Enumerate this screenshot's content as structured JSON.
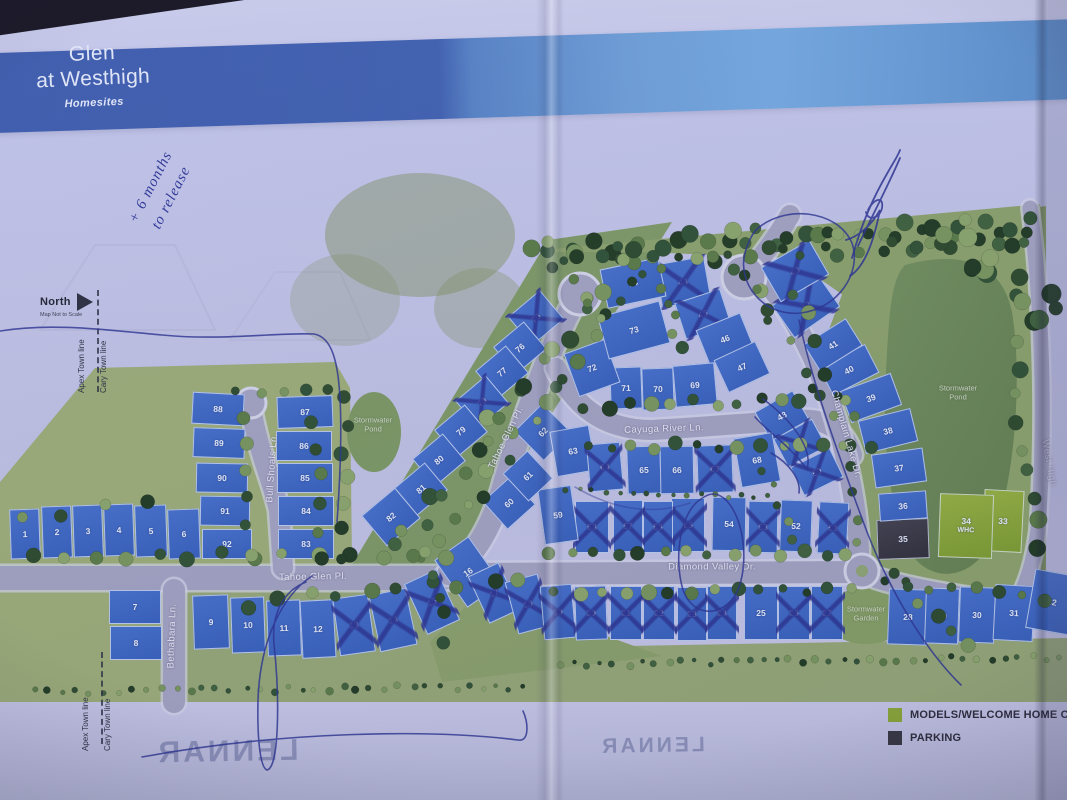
{
  "title": {
    "line1": "Glen",
    "line2": "at Westhigh",
    "subtitle": "Homesites"
  },
  "brand": {
    "name": "LENNAR"
  },
  "north": {
    "label": "North",
    "note": "Map Not to Scale"
  },
  "town_lines": {
    "left": "Apex Town line",
    "right": "Cary Town line"
  },
  "annotations": {
    "note_line1": "+ 6 months",
    "note_line2": "to release",
    "signature": "illegible-pen-signature"
  },
  "legend": {
    "items": [
      {
        "label": "MODELS/WELCOME HOME C",
        "color": "#8aa832"
      },
      {
        "label": "PARKING",
        "color": "#35353d"
      }
    ]
  },
  "whc_label": "WHC",
  "colors": {
    "header_dark": "#3b5cab",
    "header_light": "#6ea6de",
    "lot_blue": "#3f68c2",
    "model_green": "#8aa832",
    "parking_dark": "#35353d",
    "pen_ink": "#2a338f"
  },
  "street_labels": [
    {
      "name": "Tahoe Glen Pl.",
      "x": 313,
      "y": 577,
      "r": -1
    },
    {
      "name": "Tahoe Glen Pl.",
      "x": 506,
      "y": 438,
      "r": -64
    },
    {
      "name": "Bull Shoals Ln.",
      "x": 272,
      "y": 468,
      "r": -86
    },
    {
      "name": "Bethabara Ln.",
      "x": 172,
      "y": 636,
      "r": -88
    },
    {
      "name": "Cayuga River Ln.",
      "x": 664,
      "y": 429,
      "r": -2
    },
    {
      "name": "Diamond Valley Dr.",
      "x": 712,
      "y": 567,
      "r": 0
    },
    {
      "name": "Champlain Lake Dr.",
      "x": 846,
      "y": 434,
      "r": 74
    },
    {
      "name": "West High",
      "x": 1049,
      "y": 463,
      "r": 80
    }
  ],
  "area_labels": [
    {
      "text": "Stormwater\nPond",
      "x": 373,
      "y": 425
    },
    {
      "text": "Stormwater\nPond",
      "x": 958,
      "y": 393
    },
    {
      "text": "Stormwater\nGarden",
      "x": 866,
      "y": 614
    }
  ],
  "lots": [
    {
      "n": 1,
      "x": 25,
      "y": 534,
      "w": 30,
      "h": 50,
      "r": -2,
      "s": "n"
    },
    {
      "n": 2,
      "x": 57,
      "y": 532,
      "w": 30,
      "h": 52,
      "r": -2,
      "s": "n"
    },
    {
      "n": 3,
      "x": 88,
      "y": 531,
      "w": 30,
      "h": 52,
      "r": -2,
      "s": "n"
    },
    {
      "n": 4,
      "x": 119,
      "y": 530,
      "w": 30,
      "h": 52,
      "r": -2,
      "s": "n"
    },
    {
      "n": 5,
      "x": 151,
      "y": 531,
      "w": 32,
      "h": 52,
      "r": -2,
      "s": "n"
    },
    {
      "n": 6,
      "x": 184,
      "y": 534,
      "w": 32,
      "h": 50,
      "r": -2,
      "s": "n"
    },
    {
      "n": 7,
      "x": 135,
      "y": 607,
      "w": 52,
      "h": 34,
      "r": 0,
      "s": "n"
    },
    {
      "n": 8,
      "x": 136,
      "y": 643,
      "w": 52,
      "h": 34,
      "r": 0,
      "s": "n"
    },
    {
      "n": 9,
      "x": 211,
      "y": 622,
      "w": 36,
      "h": 54,
      "r": -2,
      "s": "n"
    },
    {
      "n": 10,
      "x": 248,
      "y": 625,
      "w": 34,
      "h": 56,
      "r": -2,
      "s": "n"
    },
    {
      "n": 11,
      "x": 284,
      "y": 628,
      "w": 34,
      "h": 56,
      "r": -2,
      "s": "n"
    },
    {
      "n": 12,
      "x": 318,
      "y": 629,
      "w": 34,
      "h": 58,
      "r": -3,
      "s": "n"
    },
    {
      "n": 13,
      "x": 354,
      "y": 625,
      "w": 36,
      "h": 58,
      "r": -8,
      "s": "x"
    },
    {
      "n": 14,
      "x": 393,
      "y": 620,
      "w": 38,
      "h": 58,
      "r": -12,
      "s": "x"
    },
    {
      "n": 15,
      "x": 432,
      "y": 602,
      "w": 36,
      "h": 56,
      "r": -25,
      "s": "x"
    },
    {
      "n": 16,
      "x": 468,
      "y": 572,
      "w": 42,
      "h": 58,
      "r": -35,
      "s": "n"
    },
    {
      "n": 17,
      "x": 494,
      "y": 593,
      "w": 34,
      "h": 52,
      "r": -25,
      "s": "x"
    },
    {
      "n": 18,
      "x": 528,
      "y": 604,
      "w": 34,
      "h": 54,
      "r": -15,
      "s": "x"
    },
    {
      "n": 19,
      "x": 558,
      "y": 612,
      "w": 32,
      "h": 54,
      "r": -5,
      "s": "x"
    },
    {
      "n": 20,
      "x": 591,
      "y": 613,
      "w": 32,
      "h": 54,
      "r": -2,
      "s": "x"
    },
    {
      "n": 21,
      "x": 626,
      "y": 613,
      "w": 32,
      "h": 54,
      "r": 0,
      "s": "x"
    },
    {
      "n": 22,
      "x": 659,
      "y": 613,
      "w": 32,
      "h": 54,
      "r": 0,
      "s": "x"
    },
    {
      "n": 23,
      "x": 692,
      "y": 614,
      "w": 30,
      "h": 54,
      "r": 0,
      "s": "x"
    },
    {
      "n": 24,
      "x": 722,
      "y": 613,
      "w": 30,
      "h": 54,
      "r": 0,
      "s": "x"
    },
    {
      "n": 25,
      "x": 761,
      "y": 613,
      "w": 34,
      "h": 54,
      "r": 0,
      "s": "n"
    },
    {
      "n": 26,
      "x": 794,
      "y": 613,
      "w": 32,
      "h": 54,
      "r": 0,
      "s": "x"
    },
    {
      "n": 27,
      "x": 827,
      "y": 613,
      "w": 32,
      "h": 54,
      "r": 0,
      "s": "x"
    },
    {
      "n": 28,
      "x": 908,
      "y": 617,
      "w": 40,
      "h": 56,
      "r": 2,
      "s": "n"
    },
    {
      "n": 29,
      "x": 942,
      "y": 616,
      "w": 34,
      "h": 56,
      "r": 2,
      "s": "n"
    },
    {
      "n": 30,
      "x": 977,
      "y": 615,
      "w": 36,
      "h": 56,
      "r": 2,
      "s": "n"
    },
    {
      "n": 31,
      "x": 1014,
      "y": 613,
      "w": 40,
      "h": 56,
      "r": 3,
      "s": "n"
    },
    {
      "n": 32,
      "x": 1052,
      "y": 602,
      "w": 44,
      "h": 60,
      "r": 10,
      "s": "n"
    },
    {
      "n": 33,
      "x": 1003,
      "y": 521,
      "w": 40,
      "h": 62,
      "r": 3,
      "s": "g"
    },
    {
      "n": 34,
      "x": 966,
      "y": 526,
      "w": 54,
      "h": 64,
      "r": 2,
      "s": "g"
    },
    {
      "n": 35,
      "x": 903,
      "y": 539,
      "w": 52,
      "h": 40,
      "r": -2,
      "s": "d"
    },
    {
      "n": 36,
      "x": 903,
      "y": 506,
      "w": 48,
      "h": 28,
      "r": -4,
      "s": "n"
    },
    {
      "n": 37,
      "x": 899,
      "y": 468,
      "w": 52,
      "h": 34,
      "r": -8,
      "s": "n"
    },
    {
      "n": 38,
      "x": 888,
      "y": 431,
      "w": 54,
      "h": 34,
      "r": -14,
      "s": "n"
    },
    {
      "n": 39,
      "x": 871,
      "y": 398,
      "w": 54,
      "h": 34,
      "r": -20,
      "s": "n"
    },
    {
      "n": 40,
      "x": 849,
      "y": 370,
      "w": 52,
      "h": 32,
      "r": -27,
      "s": "n"
    },
    {
      "n": 41,
      "x": 833,
      "y": 345,
      "w": 50,
      "h": 32,
      "r": -32,
      "s": "n"
    },
    {
      "n": 42,
      "x": 806,
      "y": 306,
      "w": 56,
      "h": 40,
      "r": -35,
      "s": "x"
    },
    {
      "n": 43,
      "x": 795,
      "y": 271,
      "w": 56,
      "h": 40,
      "r": -30,
      "s": "x"
    },
    {
      "n": 44,
      "x": 683,
      "y": 282,
      "w": 50,
      "h": 44,
      "r": -10,
      "s": "x"
    },
    {
      "n": 45,
      "x": 703,
      "y": 314,
      "w": 48,
      "h": 38,
      "r": -18,
      "s": "x"
    },
    {
      "n": 46,
      "x": 725,
      "y": 339,
      "w": 48,
      "h": 38,
      "r": -22,
      "s": "n"
    },
    {
      "n": 47,
      "x": 742,
      "y": 367,
      "w": 46,
      "h": 36,
      "r": -25,
      "s": "n"
    },
    {
      "n": 48,
      "x": 782,
      "y": 416,
      "w": 44,
      "h": 34,
      "r": -30,
      "s": "n"
    },
    {
      "n": 49,
      "x": 800,
      "y": 443,
      "w": 44,
      "h": 32,
      "r": -28,
      "s": "x"
    },
    {
      "n": 50,
      "x": 817,
      "y": 472,
      "w": 44,
      "h": 32,
      "r": -26,
      "s": "x"
    },
    {
      "n": 51,
      "x": 833,
      "y": 528,
      "w": 30,
      "h": 52,
      "r": 3,
      "s": "x"
    },
    {
      "n": 52,
      "x": 796,
      "y": 526,
      "w": 32,
      "h": 52,
      "r": 2,
      "s": "n"
    },
    {
      "n": 53,
      "x": 763,
      "y": 527,
      "w": 30,
      "h": 52,
      "r": 1,
      "s": "x"
    },
    {
      "n": 54,
      "x": 729,
      "y": 524,
      "w": 34,
      "h": 54,
      "r": 1,
      "s": "n"
    },
    {
      "n": 55,
      "x": 688,
      "y": 525,
      "w": 34,
      "h": 54,
      "r": 0,
      "s": "x"
    },
    {
      "n": 56,
      "x": 658,
      "y": 527,
      "w": 30,
      "h": 52,
      "r": 0,
      "s": "x"
    },
    {
      "n": 57,
      "x": 628,
      "y": 526,
      "w": 30,
      "h": 52,
      "r": 0,
      "s": "x"
    },
    {
      "n": 58,
      "x": 592,
      "y": 527,
      "w": 34,
      "h": 52,
      "r": 0,
      "s": "x"
    },
    {
      "n": 59,
      "x": 558,
      "y": 515,
      "w": 34,
      "h": 56,
      "r": -8,
      "s": "n"
    },
    {
      "n": 60,
      "x": 509,
      "y": 503,
      "w": 38,
      "h": 38,
      "r": -42,
      "s": "n"
    },
    {
      "n": 61,
      "x": 528,
      "y": 476,
      "w": 34,
      "h": 38,
      "r": -43,
      "s": "n"
    },
    {
      "n": 62,
      "x": 543,
      "y": 432,
      "w": 40,
      "h": 42,
      "r": -45,
      "s": "n"
    },
    {
      "n": 63,
      "x": 573,
      "y": 451,
      "w": 40,
      "h": 46,
      "r": -10,
      "s": "n"
    },
    {
      "n": 64,
      "x": 605,
      "y": 467,
      "w": 34,
      "h": 48,
      "r": -5,
      "s": "x"
    },
    {
      "n": 65,
      "x": 644,
      "y": 470,
      "w": 34,
      "h": 48,
      "r": -2,
      "s": "n"
    },
    {
      "n": 66,
      "x": 677,
      "y": 470,
      "w": 34,
      "h": 48,
      "r": -1,
      "s": "n"
    },
    {
      "n": 67,
      "x": 715,
      "y": 469,
      "w": 36,
      "h": 48,
      "r": -2,
      "s": "x"
    },
    {
      "n": 68,
      "x": 757,
      "y": 460,
      "w": 40,
      "h": 50,
      "r": -10,
      "s": "n"
    },
    {
      "n": 69,
      "x": 695,
      "y": 385,
      "w": 42,
      "h": 42,
      "r": -5,
      "s": "n"
    },
    {
      "n": 70,
      "x": 658,
      "y": 389,
      "w": 32,
      "h": 42,
      "r": -2,
      "s": "n"
    },
    {
      "n": 71,
      "x": 626,
      "y": 388,
      "w": 32,
      "h": 42,
      "r": -2,
      "s": "n"
    },
    {
      "n": 72,
      "x": 592,
      "y": 368,
      "w": 44,
      "h": 46,
      "r": -20,
      "s": "n"
    },
    {
      "n": 73,
      "x": 634,
      "y": 330,
      "w": 64,
      "h": 44,
      "r": -15,
      "s": "n"
    },
    {
      "n": 74,
      "x": 633,
      "y": 283,
      "w": 60,
      "h": 40,
      "r": -12,
      "s": "n"
    },
    {
      "n": 75,
      "x": 536,
      "y": 318,
      "w": 42,
      "h": 38,
      "r": -40,
      "s": "x"
    },
    {
      "n": 76,
      "x": 520,
      "y": 348,
      "w": 40,
      "h": 36,
      "r": -40,
      "s": "n"
    },
    {
      "n": 77,
      "x": 502,
      "y": 372,
      "w": 40,
      "h": 36,
      "r": -40,
      "s": "n"
    },
    {
      "n": 78,
      "x": 482,
      "y": 402,
      "w": 40,
      "h": 36,
      "r": -40,
      "s": "x"
    },
    {
      "n": 79,
      "x": 461,
      "y": 431,
      "w": 40,
      "h": 36,
      "r": -40,
      "s": "n"
    },
    {
      "n": 80,
      "x": 439,
      "y": 460,
      "w": 40,
      "h": 36,
      "r": -40,
      "s": "n"
    },
    {
      "n": 81,
      "x": 421,
      "y": 489,
      "w": 40,
      "h": 36,
      "r": -40,
      "s": "n"
    },
    {
      "n": 82,
      "x": 391,
      "y": 517,
      "w": 44,
      "h": 40,
      "r": -40,
      "s": "n"
    },
    {
      "n": 83,
      "x": 306,
      "y": 544,
      "w": 56,
      "h": 30,
      "r": 0,
      "s": "n"
    },
    {
      "n": 84,
      "x": 306,
      "y": 511,
      "w": 56,
      "h": 30,
      "r": 0,
      "s": "n"
    },
    {
      "n": 85,
      "x": 305,
      "y": 478,
      "w": 56,
      "h": 30,
      "r": 0,
      "s": "n"
    },
    {
      "n": 86,
      "x": 304,
      "y": 446,
      "w": 56,
      "h": 30,
      "r": 0,
      "s": "n"
    },
    {
      "n": 87,
      "x": 305,
      "y": 412,
      "w": 56,
      "h": 32,
      "r": -2,
      "s": "n"
    },
    {
      "n": 88,
      "x": 218,
      "y": 409,
      "w": 52,
      "h": 32,
      "r": 3,
      "s": "n"
    },
    {
      "n": 89,
      "x": 219,
      "y": 443,
      "w": 52,
      "h": 30,
      "r": 2,
      "s": "n"
    },
    {
      "n": 90,
      "x": 222,
      "y": 478,
      "w": 52,
      "h": 30,
      "r": 1,
      "s": "n"
    },
    {
      "n": 91,
      "x": 225,
      "y": 511,
      "w": 50,
      "h": 30,
      "r": 1,
      "s": "n"
    },
    {
      "n": 92,
      "x": 227,
      "y": 544,
      "w": 50,
      "h": 30,
      "r": 0,
      "s": "n"
    }
  ]
}
